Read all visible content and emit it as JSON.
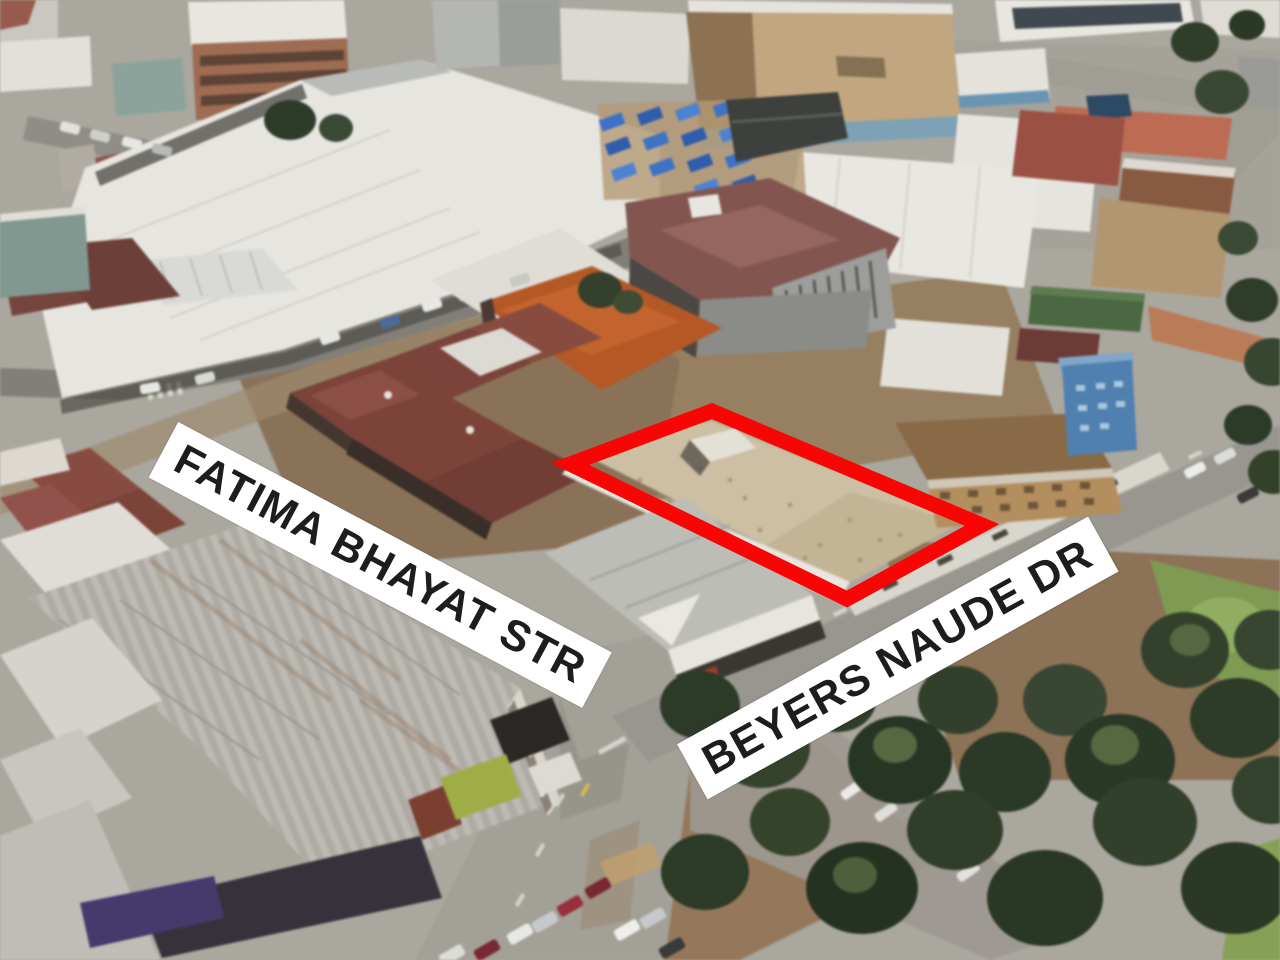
{
  "scene": {
    "type": "3d-aerial-photo",
    "subject": "city block at street intersection with highlighted property",
    "palette": {
      "road_gray": "#9a978f",
      "dirt_brown": "#8b7258",
      "roof_white": "#e8e6df",
      "roof_maroon": "#7d4238",
      "roof_terracotta": "#b85722",
      "subject_roof_tan": "#cdbfa2",
      "market_tarp_blue": "#3a72cc",
      "tree_green": "#2f3d28",
      "grass_green": "#7d9b50"
    }
  },
  "annotations": {
    "highlight": {
      "name": "property-boundary",
      "color": "#fa0505"
    },
    "street_labels": [
      {
        "text": "FATIMA BHAYAT STR",
        "bg": "#ffffff",
        "fg": "#1d1d1d"
      },
      {
        "text": "BEYERS NAUDE DR",
        "bg": "#ffffff",
        "fg": "#1d1d1d"
      }
    ]
  }
}
